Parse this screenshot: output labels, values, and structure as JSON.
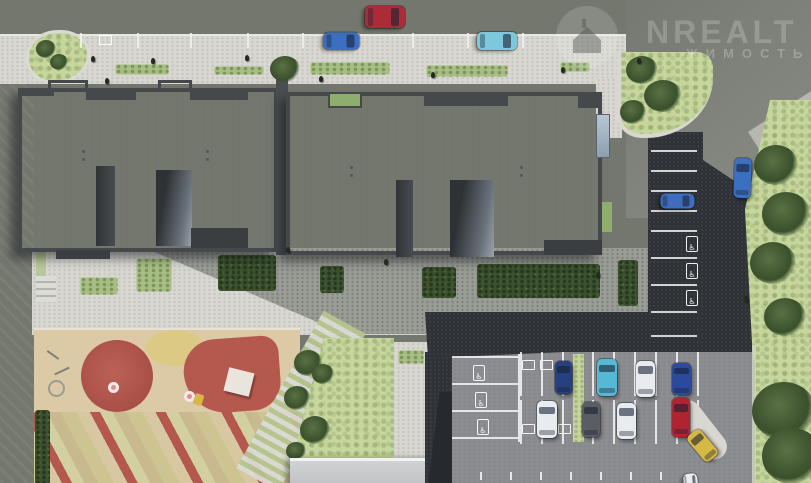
{
  "watermark": {
    "icon": "house-in-circle-icon",
    "brand_text": "NREALT",
    "subtitle_text": "ЖИМОСТЬ"
  },
  "scene": {
    "type": "aerial-3d-site-plan-render",
    "features": [
      "apartment-building-roofs",
      "street-parking",
      "disabled-parking-spaces",
      "courtyard-hedges",
      "children-playground",
      "lawn-with-trees",
      "rear-parking-lot",
      "access-roads"
    ],
    "icons": [
      "house-in-circle-icon",
      "disabled-parking-icon"
    ],
    "colors": {
      "road": "#73776e",
      "sidewalk": "#d8d7d1",
      "roof": "#e9ebee",
      "parapet": "#45494b",
      "asphalt_dark": "#2f3337",
      "parking_light": "#8b8d90",
      "grass": "#c6d69d",
      "tree": "#3c512f",
      "playground_sand": "#dcc9a6",
      "playground_red": "#b4584e",
      "playground_yellow": "#dcca84",
      "car_red": "#ab2b36",
      "car_blue": "#3b6fc0",
      "car_cyan": "#7ec8dd",
      "car_white": "#e9ecef",
      "car_navy": "#27407f",
      "car_gray": "#5a5e64",
      "taxi_yellow": "#d6b845"
    }
  }
}
